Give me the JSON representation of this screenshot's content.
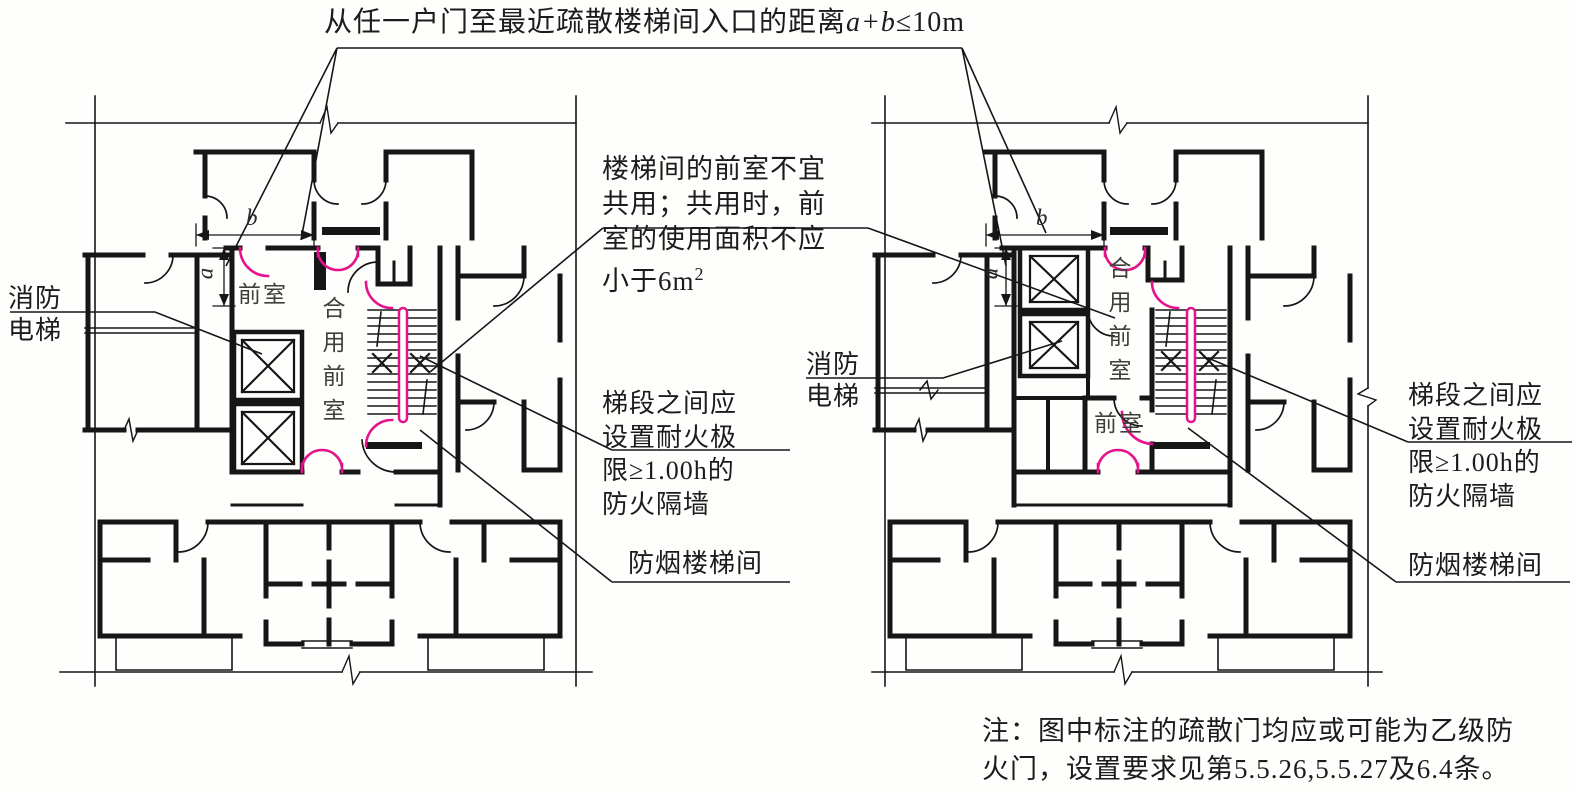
{
  "colors": {
    "line": "#161616",
    "door_highlight_magenta": "#e5128c",
    "text": "#1c1c1c",
    "room_label": "#3f3f3a"
  },
  "title": {
    "prefix": "从任一户门至最近疏散楼梯间入口的距离",
    "variables": "a+b",
    "suffix": "≤10m"
  },
  "labels": {
    "front_room": "前室",
    "shared_front_room": "合用前室",
    "fire_elevator_line1": "消防",
    "fire_elevator_line2": "电梯",
    "smokeproof_staircase": "防烟楼梯间",
    "dim_a": "a",
    "dim_b": "b"
  },
  "annotations": {
    "shared_lobby_note": {
      "line1": "楼梯间的前室不宜",
      "line2": "共用；共用时，前",
      "line3": "室的使用面积不应",
      "line4": "小于6m",
      "line4_sup": "2"
    },
    "partition_note": {
      "line1": "梯段之间应",
      "line2": "设置耐火极",
      "line3": "限≥1.00h的",
      "line4": "防火隔墙"
    }
  },
  "footnote": {
    "line1": "注：图中标注的疏散门均应或可能为乙级防",
    "line2": "火门，设置要求见第5.5.26,5.5.27及6.4条。"
  }
}
